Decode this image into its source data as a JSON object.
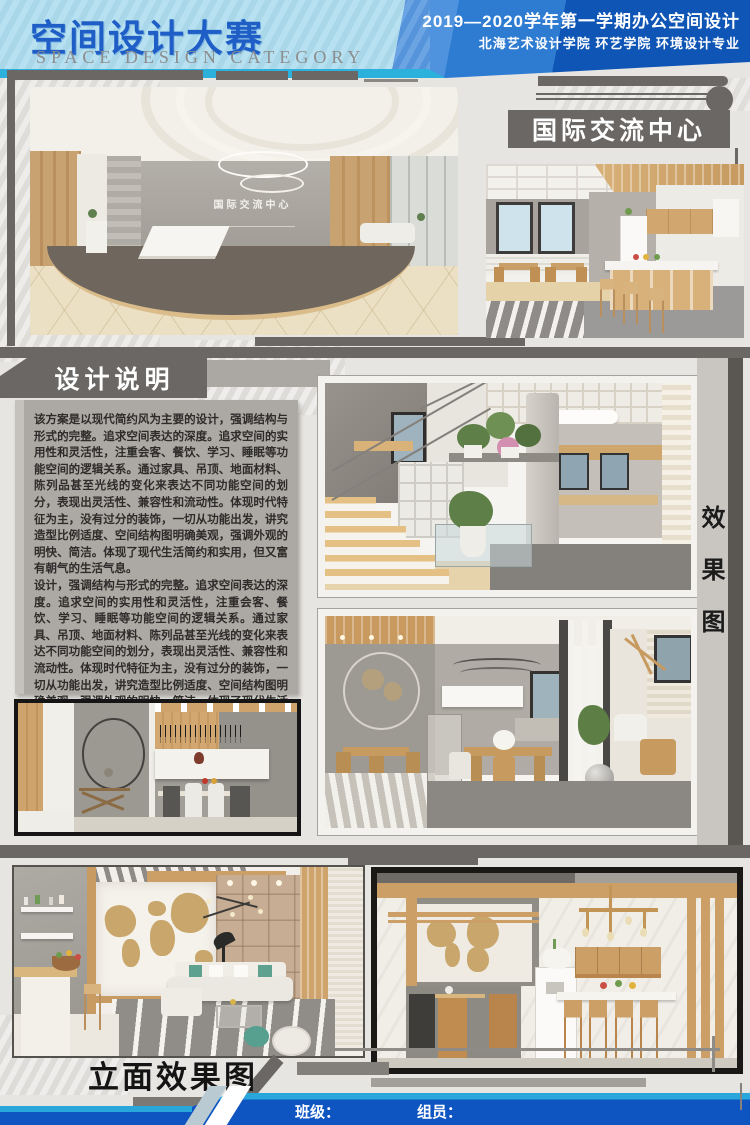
{
  "header": {
    "title_cn": "空间设计大赛",
    "title_en": "SPACE DESIGN CATEGORY",
    "semester_line": "2019—2020学年第一学期办公空间设计",
    "school_line": "北海艺术设计学院 环艺学院 环境设计专业"
  },
  "center_badge": {
    "label": "国际交流中心"
  },
  "lobby_image": {
    "wall_sign": "国际交流中心"
  },
  "design_notes": {
    "title": "设计说明",
    "paragraph1": "该方案是以现代简约风为主要的设计，强调结构与形式的完整。追求空间表达的深度。追求空间的实用性和灵活性，注重会客、餐饮、学习、睡眠等功能空间的逻辑关系。通过家具、吊顶、地面材料、陈列品甚至光线的变化来表达不同功能空间的划分，表现出灵活性、兼容性和流动性。体现时代特征为主，没有过分的装饰，一切从功能出发，讲究造型比例适度、空间结构图明确美观，强调外观的明快、简洁。体现了现代生活简约和实用，但又富有朝气的生活气息。",
    "paragraph2": "设计，强调结构与形式的完整。追求空间表达的深度。追求空间的实用性和灵活性，注重会客、餐饮、学习、睡眠等功能空间的逻辑关系。通过家具、吊顶、地面材料、陈列品甚至光线的变化来表达不同功能空间的划分，表现出灵活性、兼容性和流动性。体现时代特征为主，没有过分的装饰，一切从功能出发，讲究造型比例适度、空间结构图明确美观，强调外观的明快、简洁。体现了现代生活简约和实用，但又富有朝气的生活气息。"
  },
  "labels": {
    "renderings_vertical": "效果图",
    "elevation_title": "立面效果图"
  },
  "footer": {
    "class_label": "班级：",
    "members_label": "组员："
  },
  "colors": {
    "header_light_blue": "#A9DBEE",
    "header_mid_blue": "#2E7BD2",
    "header_dark_blue": "#0F55B5",
    "title_blue": "#1E5EC6",
    "accent_cyan": "#2AA7DA",
    "footer_blue": "#0F55C2",
    "bar_gray": "#6B6764",
    "panel_gray": "#ACA9A5",
    "wood": "#CC9F66"
  }
}
